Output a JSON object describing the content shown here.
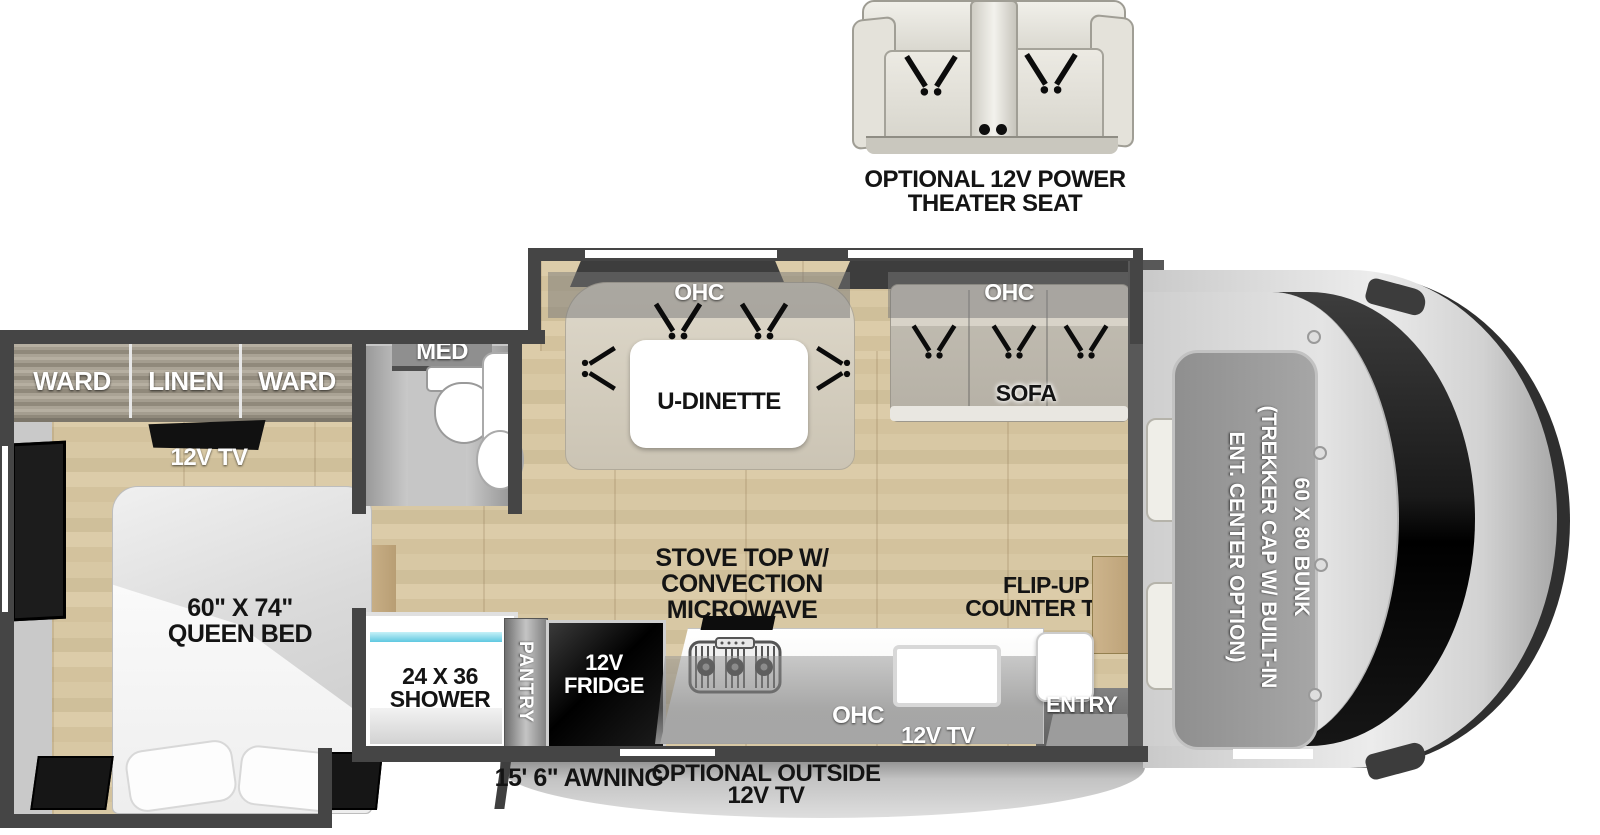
{
  "theater_seat": {
    "label": [
      "OPTIONAL 12V POWER",
      "THEATER SEAT"
    ]
  },
  "bedroom": {
    "ward_left": "WARD",
    "linen": "LINEN",
    "ward_right": "WARD",
    "tv_label": "12V TV",
    "bed_label": [
      "60\" X 74\"",
      "QUEEN BED"
    ]
  },
  "bath": {
    "med_label": "MED",
    "shower_label": [
      "24 X 36",
      "SHOWER"
    ]
  },
  "dinette": {
    "ohc_label": "OHC",
    "table_label": "U-DINETTE"
  },
  "sofa": {
    "ohc_label": "OHC",
    "label": "SOFA"
  },
  "kitchen": {
    "stove_label": [
      "STOVE TOP W/",
      "CONVECTION",
      "MICROWAVE"
    ],
    "pantry_label": "PANTRY",
    "fridge_label": [
      "12V",
      "FRIDGE"
    ],
    "flip_counter_label": [
      "FLIP-UP",
      "COUNTER TOP"
    ],
    "ohc_label": "OHC",
    "tv_label": "12V TV"
  },
  "entry": {
    "label": "ENTRY"
  },
  "cab": {
    "bunk_label": [
      "60 X 80 BUNK",
      "(TREKKER CAP W/ BUILT-IN",
      "ENT. CENTER OPTION)"
    ]
  },
  "exterior": {
    "awning_label": "15' 6\" AWNING",
    "outside_tv_label": [
      "OPTIONAL OUTSIDE",
      "12V TV"
    ]
  },
  "colors": {
    "wall": "#454545",
    "floor_wood": "#d6c5a0",
    "accent_glass": "#5fc8e0",
    "appliance_black": "#0d0d0d"
  }
}
